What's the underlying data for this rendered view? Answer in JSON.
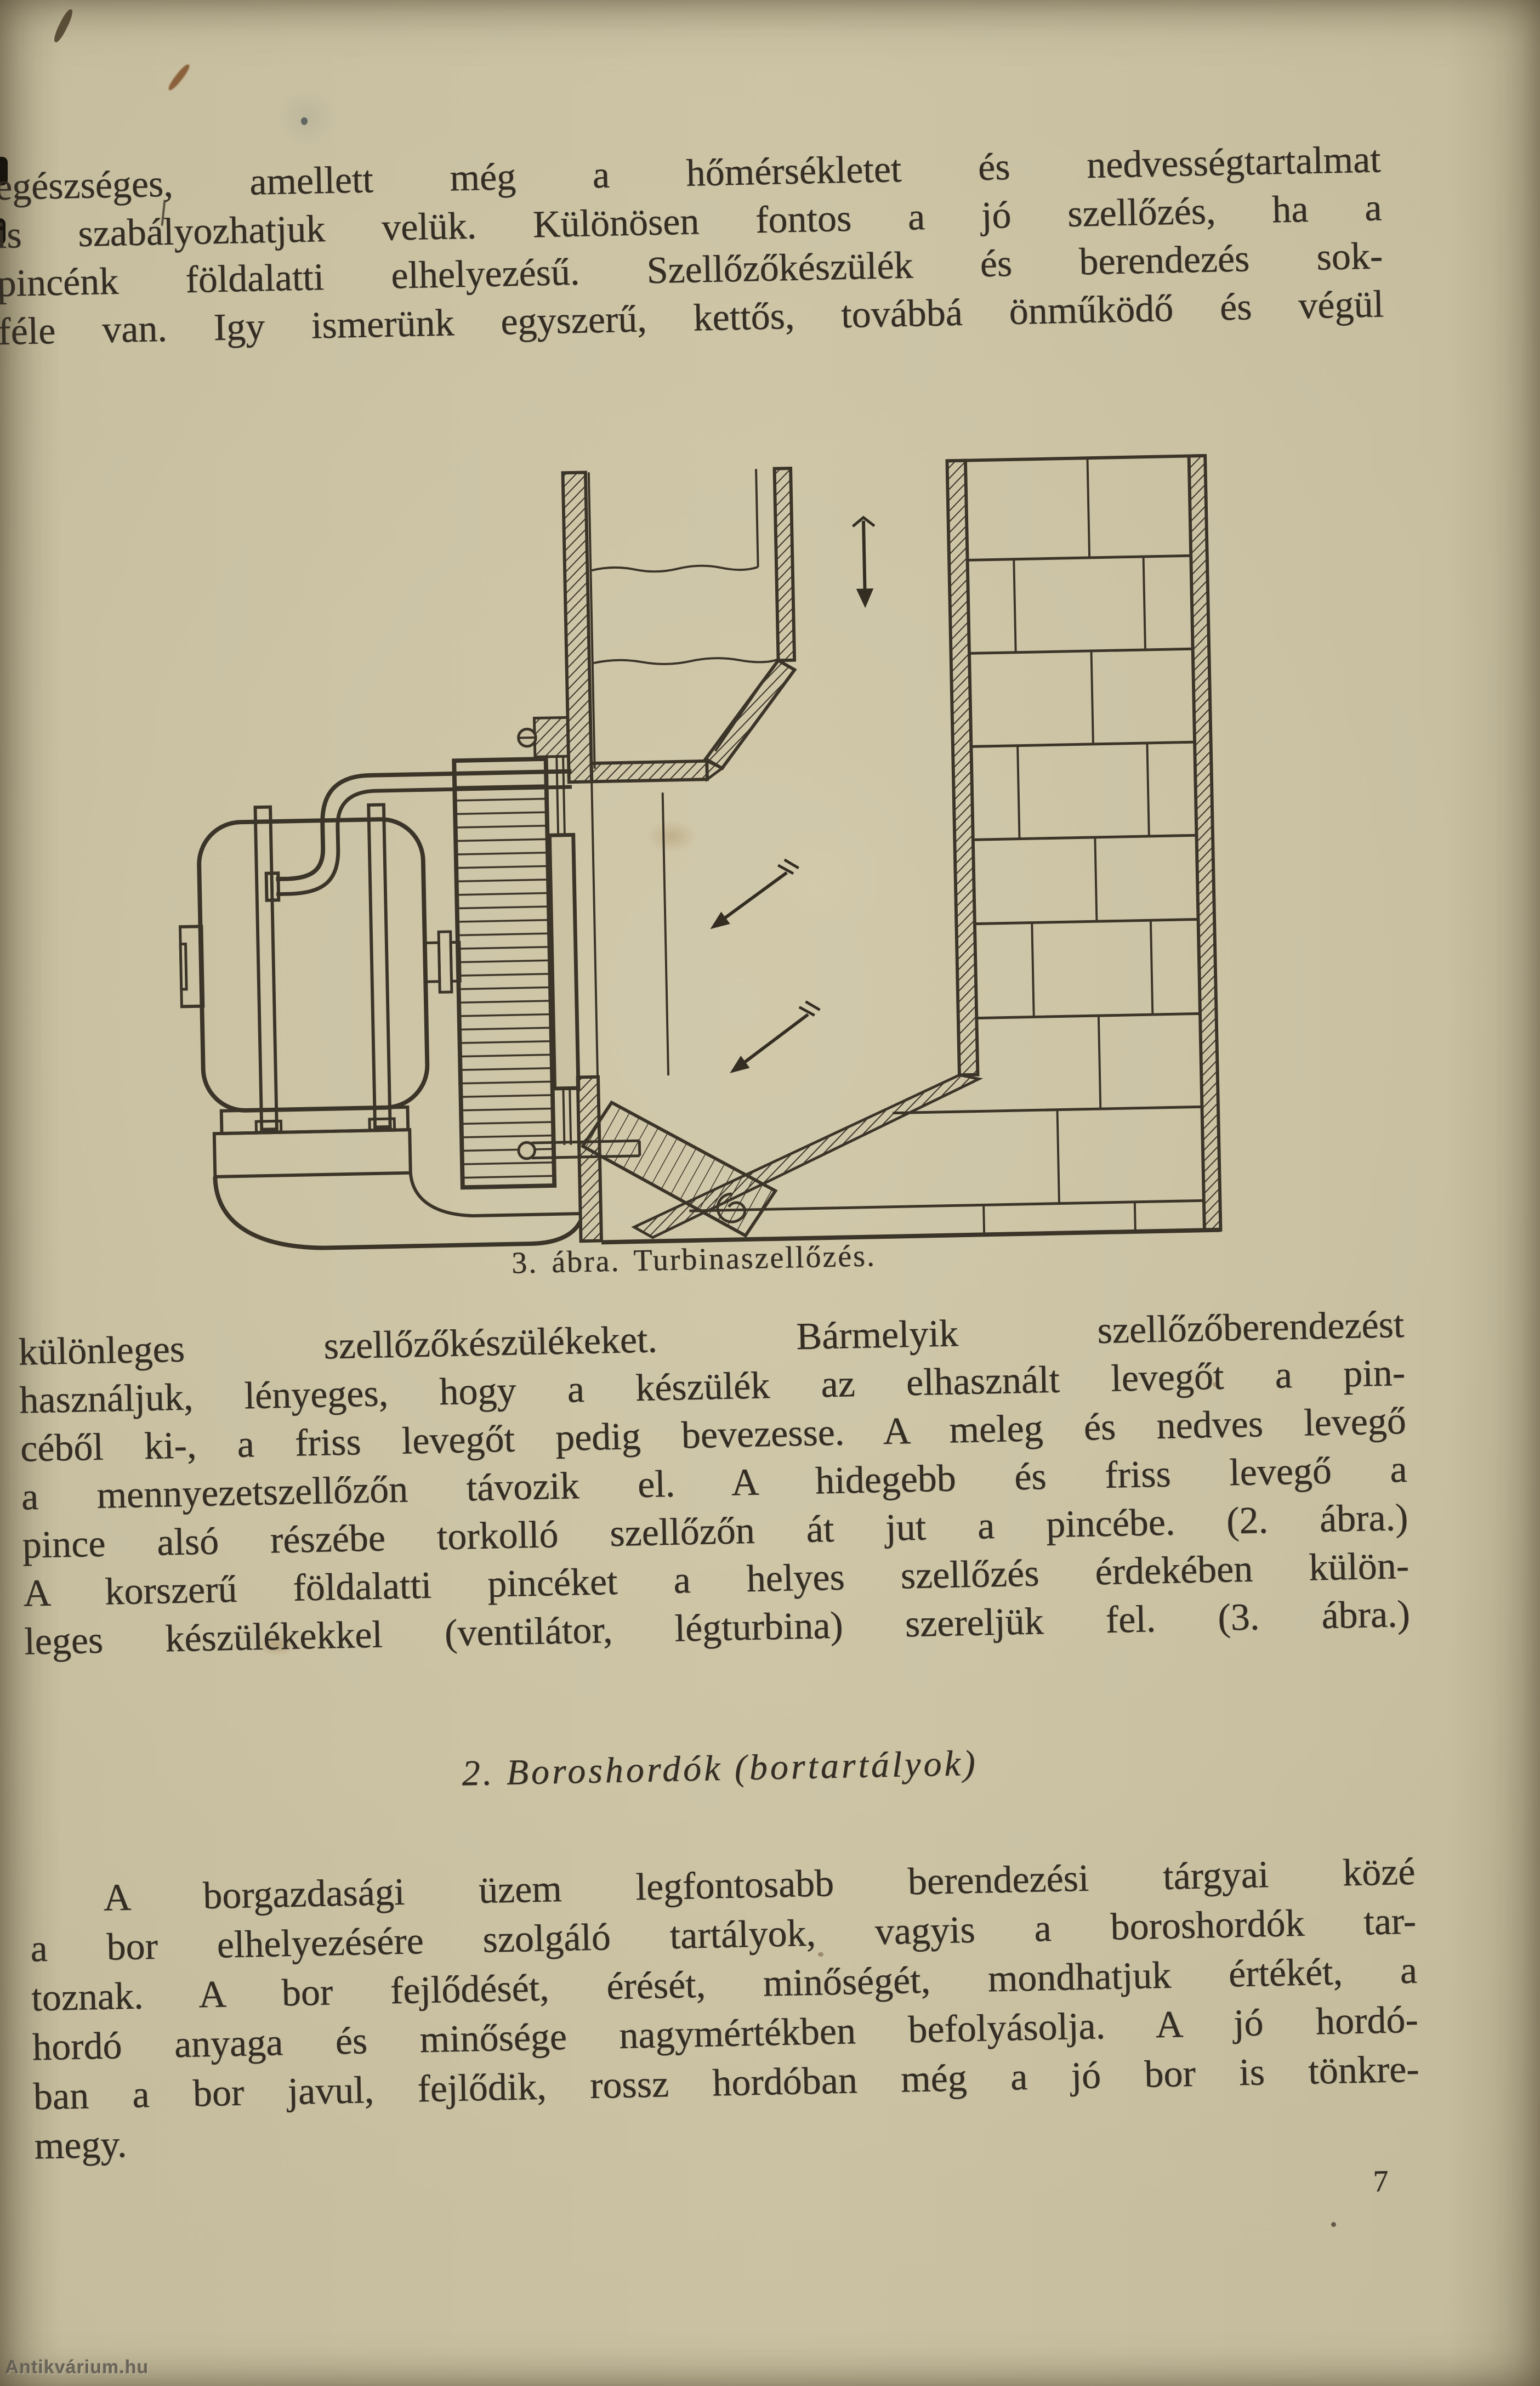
{
  "page": {
    "paragraph1": {
      "lines": [
        "egészséges, amellett még a hőmérsékletet és nedvességtartalmat",
        "is szabályozhatjuk velük. Különösen fontos a jó szellőzés, ha a",
        "pincénk földalatti elhelyezésű. Szellőzőkészülék és berendezés sok-",
        "féle van. Igy ismerünk egyszerű, kettős, továbbá önműködő és végül"
      ]
    },
    "figure": {
      "caption": "3. ábra. Turbinaszellőzés."
    },
    "paragraph2": {
      "lines": [
        "különleges szellőzőkészülékeket. Bármelyik szellőzőberendezést",
        "használjuk, lényeges, hogy a készülék az elhasznált levegőt a pin-",
        "céből ki-, a friss levegőt pedig bevezesse. A meleg és nedves levegő",
        "a mennyezetszellőzőn távozik el. A hidegebb és friss levegő a",
        "pince alsó részébe torkolló szellőzőn át jut a pincébe. (2. ábra.)",
        "A korszerű földalatti pincéket a helyes szellőzés érdekében külön-",
        "leges készülékekkel (ventilátor, légturbina) szereljük fel. (3. ábra.)"
      ]
    },
    "section_heading": "2. Boroshordók (bortartályok)",
    "paragraph3": {
      "lines": [
        "A borgazdasági üzem legfontosabb berendezési tárgyai közé",
        "a bor elhelyezésére szolgáló tartályok, vagyis a boroshordók tar-",
        "toznak. A bor fejlődését, érését, minőségét, mondhatjuk értékét, a",
        "hordó anyaga és minősége nagymértékben befolyásolja. A jó hordó-",
        "ban a bor javul, fejlődik, rossz hordóban még a jó bor is tönkre-",
        "megy."
      ]
    },
    "page_number": "7",
    "watermark": "Antikvárium.hu",
    "colors": {
      "paper": "#c9c09f",
      "ink": "#332d24"
    }
  }
}
